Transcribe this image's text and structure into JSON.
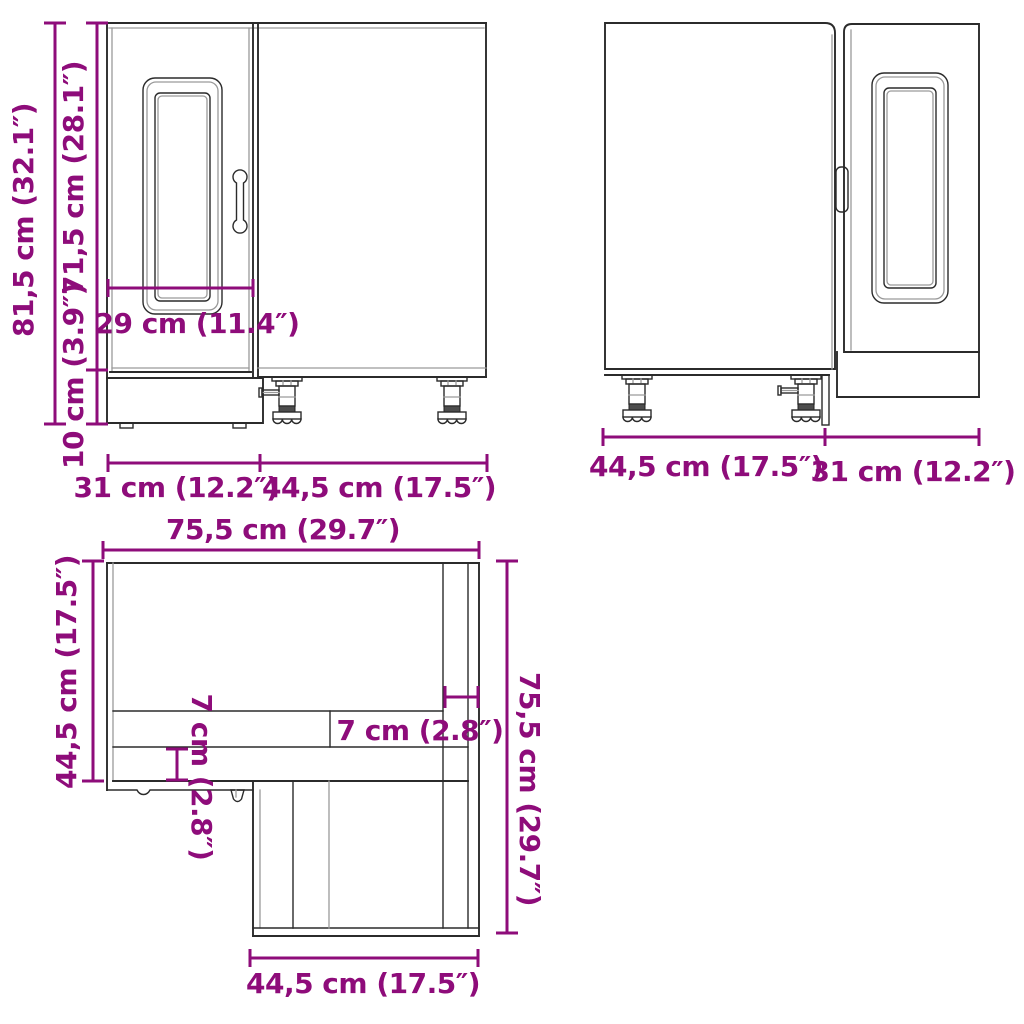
{
  "colors": {
    "background": "#ffffff",
    "dimension": "#8e0c7a",
    "line": "#2b2b2b",
    "line_light": "#9a9a9a"
  },
  "front_view": {
    "total_height": "81,5 cm (32.1″)",
    "cabinet_height": "71,5 cm (28.1″)",
    "leg_height": "10 cm (3.9″)",
    "door_width": "29 cm (11.4″)",
    "left_section_width": "31 cm (12.2″)",
    "right_section_width": "44,5 cm (17.5″)"
  },
  "back_view": {
    "left_section_width": "44,5 cm (17.5″)",
    "right_section_width": "31 cm (12.2″)"
  },
  "top_view": {
    "top_width": "75,5 cm (29.7″)",
    "left_depth": "44,5 cm (17.5″)",
    "recess_depth": "7 cm (2.8″)",
    "front_panel_depth": "7 cm (2.8″)",
    "right_depth": "75,5 cm (29.7″)",
    "bottom_width": "44,5 cm (17.5″)"
  }
}
